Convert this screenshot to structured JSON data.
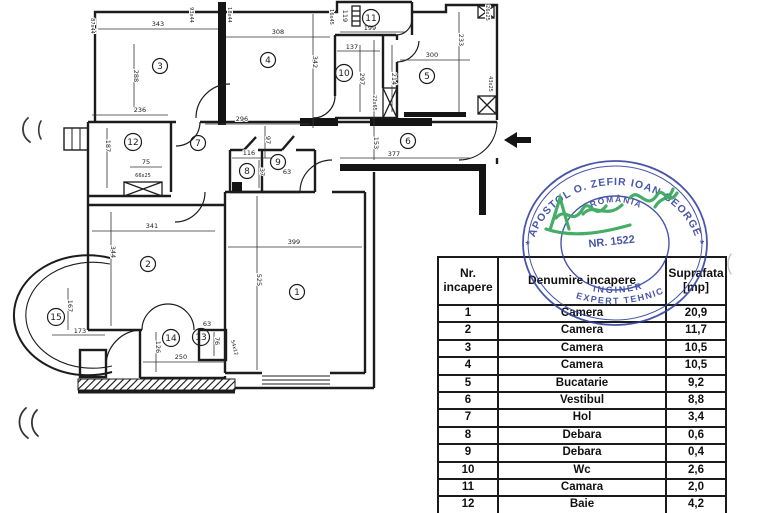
{
  "document": {
    "type_label": "apartment floor plan with room area table, engineer stamp and signature"
  },
  "table": {
    "header": {
      "nr_line1": "Nr.",
      "nr_line2": "incapere",
      "name": "Denumire incapere",
      "area_line1": "Suprafata",
      "area_line2": "[mp]"
    },
    "rows": [
      {
        "nr": "1",
        "name": "Camera",
        "area": "20,9"
      },
      {
        "nr": "2",
        "name": "Camera",
        "area": "11,7"
      },
      {
        "nr": "3",
        "name": "Camera",
        "area": "10,5"
      },
      {
        "nr": "4",
        "name": "Camera",
        "area": "10,5"
      },
      {
        "nr": "5",
        "name": "Bucatarie",
        "area": "9,2"
      },
      {
        "nr": "6",
        "name": "Vestibul",
        "area": "8,8"
      },
      {
        "nr": "7",
        "name": "Hol",
        "area": "3,4"
      },
      {
        "nr": "8",
        "name": "Debara",
        "area": "0,6"
      },
      {
        "nr": "9",
        "name": "Debara",
        "area": "0,4"
      },
      {
        "nr": "10",
        "name": "Wc",
        "area": "2,6"
      },
      {
        "nr": "11",
        "name": "Camara",
        "area": "2,0"
      },
      {
        "nr": "12",
        "name": "Baie",
        "area": "4,2"
      }
    ]
  },
  "stamp": {
    "ring_text": "* APOSTOL O. ZEFIR IOAN GEORGE *",
    "country": "ROMÂNIA",
    "number": "NR. 1522",
    "title1": "INGINER",
    "title2": "EXPERT TEHNIC",
    "ink_color": "#2f3e9e",
    "signature_color": "#1f9e48"
  },
  "floorplan": {
    "rooms": [
      {
        "n": "1",
        "x": 297,
        "y": 292
      },
      {
        "n": "2",
        "x": 148,
        "y": 264
      },
      {
        "n": "3",
        "x": 160,
        "y": 66
      },
      {
        "n": "4",
        "x": 268,
        "y": 60
      },
      {
        "n": "5",
        "x": 427,
        "y": 76
      },
      {
        "n": "6",
        "x": 408,
        "y": 141
      },
      {
        "n": "7",
        "x": 198,
        "y": 143
      },
      {
        "n": "8",
        "x": 247,
        "y": 171
      },
      {
        "n": "9",
        "x": 278,
        "y": 162
      },
      {
        "n": "10",
        "x": 344,
        "y": 73
      },
      {
        "n": "11",
        "x": 371,
        "y": 18
      },
      {
        "n": "12",
        "x": 133,
        "y": 142
      },
      {
        "n": "13",
        "x": 201,
        "y": 337
      },
      {
        "n": "14",
        "x": 171,
        "y": 338
      },
      {
        "n": "15",
        "x": 56,
        "y": 317
      }
    ],
    "dims": [
      {
        "t": "343",
        "x": 158,
        "y": 26
      },
      {
        "t": "308",
        "x": 278,
        "y": 34
      },
      {
        "t": "288",
        "x": 134,
        "y": 76,
        "r": 90
      },
      {
        "t": "87x44",
        "x": 91,
        "y": 26,
        "r": 90,
        "s": 1
      },
      {
        "t": "93x44",
        "x": 190,
        "y": 15,
        "r": 90,
        "s": 1
      },
      {
        "t": "18x44",
        "x": 228,
        "y": 15,
        "r": 90,
        "s": 1
      },
      {
        "t": "16x45",
        "x": 330,
        "y": 17,
        "r": 90,
        "s": 1
      },
      {
        "t": "119",
        "x": 343,
        "y": 16,
        "r": 90
      },
      {
        "t": "199",
        "x": 370,
        "y": 30
      },
      {
        "t": "137",
        "x": 352,
        "y": 49
      },
      {
        "t": "342",
        "x": 313,
        "y": 62,
        "r": 90
      },
      {
        "t": "297",
        "x": 360,
        "y": 79,
        "r": 90
      },
      {
        "t": "214",
        "x": 392,
        "y": 79,
        "r": 90
      },
      {
        "t": "22x65",
        "x": 373,
        "y": 103,
        "r": 90,
        "s": 1
      },
      {
        "t": "300",
        "x": 432,
        "y": 57
      },
      {
        "t": "233",
        "x": 459,
        "y": 40,
        "r": 90
      },
      {
        "t": "26x25",
        "x": 486,
        "y": 13,
        "r": 90,
        "s": 1
      },
      {
        "t": "43x25",
        "x": 489,
        "y": 84,
        "r": 90,
        "s": 1
      },
      {
        "t": "236",
        "x": 140,
        "y": 112
      },
      {
        "t": "187",
        "x": 106,
        "y": 146,
        "r": 90
      },
      {
        "t": "66x25",
        "x": 143,
        "y": 177,
        "s": 1
      },
      {
        "t": "296",
        "x": 242,
        "y": 121
      },
      {
        "t": "97",
        "x": 266,
        "y": 140,
        "r": 90
      },
      {
        "t": "116",
        "x": 249,
        "y": 155
      },
      {
        "t": "37",
        "x": 260,
        "y": 172,
        "r": 90
      },
      {
        "t": "63",
        "x": 287,
        "y": 174
      },
      {
        "t": "75",
        "x": 146,
        "y": 164
      },
      {
        "t": "153",
        "x": 374,
        "y": 143,
        "r": 90
      },
      {
        "t": "377",
        "x": 394,
        "y": 156
      },
      {
        "t": "341",
        "x": 152,
        "y": 228
      },
      {
        "t": "344",
        "x": 111,
        "y": 252,
        "r": 90
      },
      {
        "t": "399",
        "x": 294,
        "y": 244
      },
      {
        "t": "525",
        "x": 257,
        "y": 280,
        "r": 90
      },
      {
        "t": "167",
        "x": 68,
        "y": 306,
        "r": 90
      },
      {
        "t": "173",
        "x": 80,
        "y": 333
      },
      {
        "t": "126",
        "x": 156,
        "y": 347,
        "r": 90
      },
      {
        "t": "250",
        "x": 181,
        "y": 359
      },
      {
        "t": "63",
        "x": 207,
        "y": 326
      },
      {
        "t": "76",
        "x": 215,
        "y": 341,
        "r": 90
      },
      {
        "t": "54x12",
        "x": 233,
        "y": 348,
        "r": 75,
        "s": 1
      }
    ]
  }
}
